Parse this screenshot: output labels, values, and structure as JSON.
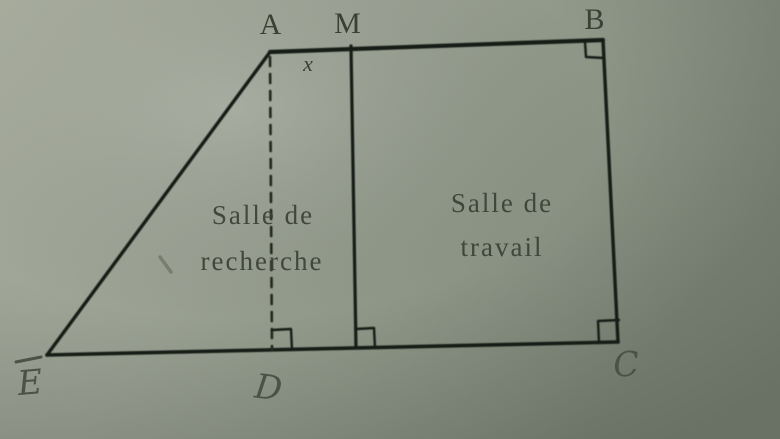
{
  "figure": {
    "kind": "geometry-floor-plan-photo",
    "points": {
      "A": "A",
      "M": "M",
      "B": "B",
      "C": "C",
      "D": "D",
      "E": "E"
    },
    "segment_label_x": "x",
    "rooms": {
      "recherche": {
        "line1": "Salle de",
        "line2": "recherche"
      },
      "travail": {
        "line1": "Salle de",
        "line2": "travail"
      }
    },
    "right_angles_at": [
      "B",
      "C",
      "D",
      "M-foot"
    ],
    "colors": {
      "paper_light": "#a9ae9f",
      "paper_mid": "#99a092",
      "paper_dark": "#7d8778",
      "ink": "#191c13",
      "dash_ink": "#23271c",
      "print_text": "#3a3f34",
      "pencil": "#4d5247"
    }
  }
}
